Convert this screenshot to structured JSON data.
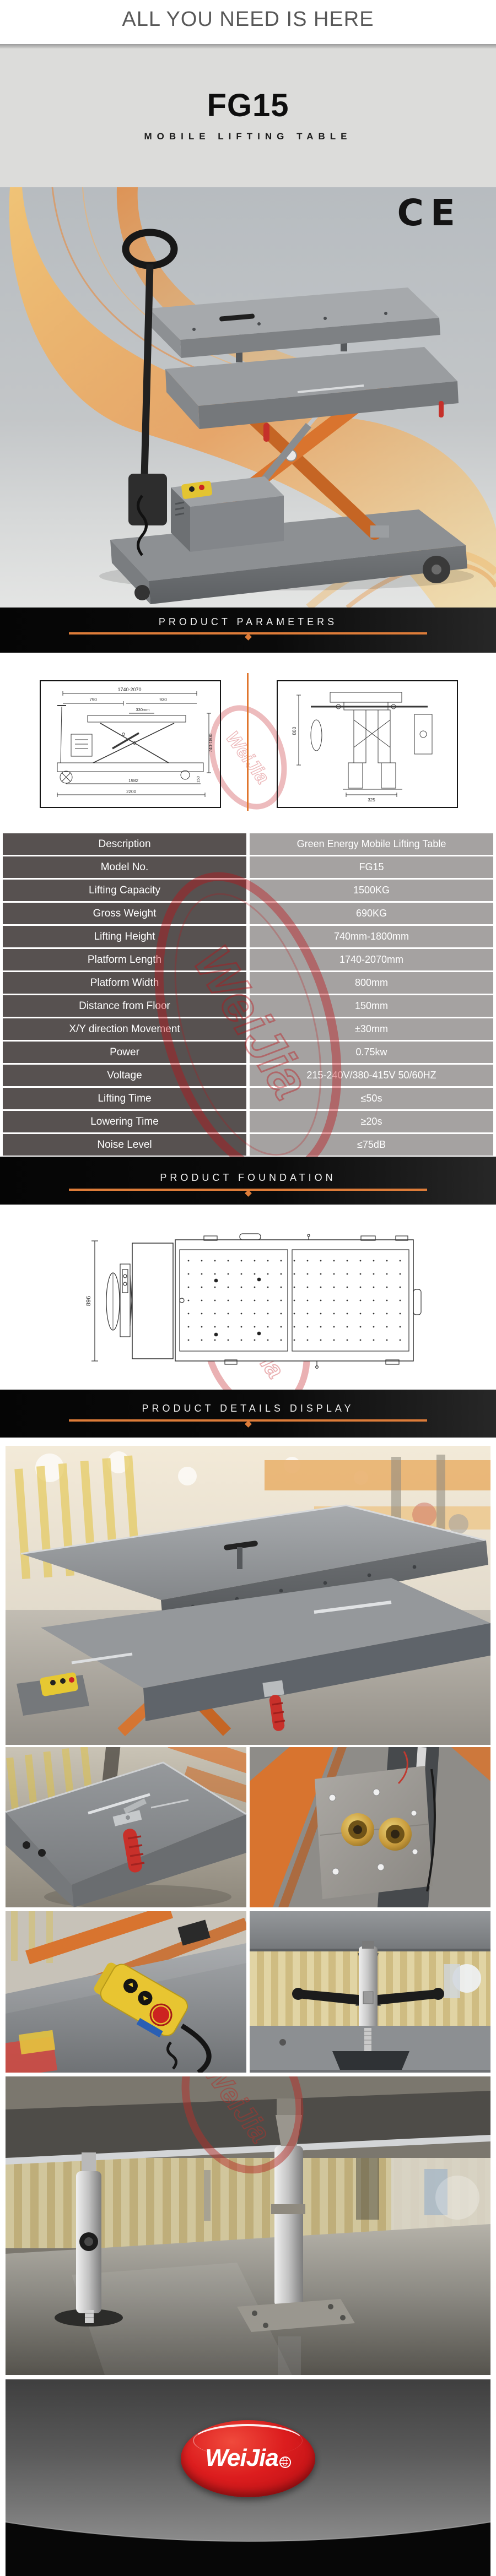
{
  "header": {
    "tagline": "ALL YOU NEED IS HERE",
    "model": "FG15",
    "subtitle": "MOBILE LIFTING TABLE",
    "ce_mark": "CE"
  },
  "banners": {
    "parameters": "PRODUCT PARAMETERS",
    "foundation": "PRODUCT FOUNDATION",
    "details": "PRODUCT DETAILS DISPLAY"
  },
  "drawings": {
    "side_view": {
      "dim_top": "1740-2070",
      "dim_left_segment": "790",
      "dim_right_segment": "930",
      "dim_platform": "330mm",
      "dim_base": "1982",
      "dim_overall": "2200",
      "dim_height": "740-1800",
      "dim_floor": "150"
    },
    "end_view": {
      "dim_width": "800",
      "dim_track": "325"
    },
    "foundation_view": {
      "dim_width": "896"
    }
  },
  "spec_table": {
    "rows": [
      {
        "label": "Description",
        "value": "Green Energy Mobile Lifting Table"
      },
      {
        "label": "Model No.",
        "value": "FG15"
      },
      {
        "label": "Lifting Capacity",
        "value": "1500KG"
      },
      {
        "label": "Gross Weight",
        "value": "690KG"
      },
      {
        "label": "Lifting Height",
        "value": "740mm-1800mm"
      },
      {
        "label": "Platform Length",
        "value": "1740-2070mm"
      },
      {
        "label": "Platform Width",
        "value": "800mm"
      },
      {
        "label": "Distance from Floor",
        "value": "150mm"
      },
      {
        "label": "X/Y direction Movement",
        "value": "±30mm"
      },
      {
        "label": "Power",
        "value": "0.75kw"
      },
      {
        "label": "Voltage",
        "value": "215-240V/380-415V  50/60HZ"
      },
      {
        "label": "Lifting Time",
        "value": "≤50s"
      },
      {
        "label": "Lowering Time",
        "value": "≥20s"
      },
      {
        "label": "Noise Level",
        "value": "≤75dB"
      }
    ]
  },
  "watermark": {
    "text": "WeiJia"
  },
  "footer": {
    "logo_text": "WeiJia"
  },
  "colors": {
    "accent_orange": "#dd7c39",
    "table_label_bg": "#575150",
    "table_value_bg": "#a5a2a1",
    "watermark_red": "#c01016",
    "logo_red": "#d41317",
    "scissor_orange": "#d9742e"
  }
}
